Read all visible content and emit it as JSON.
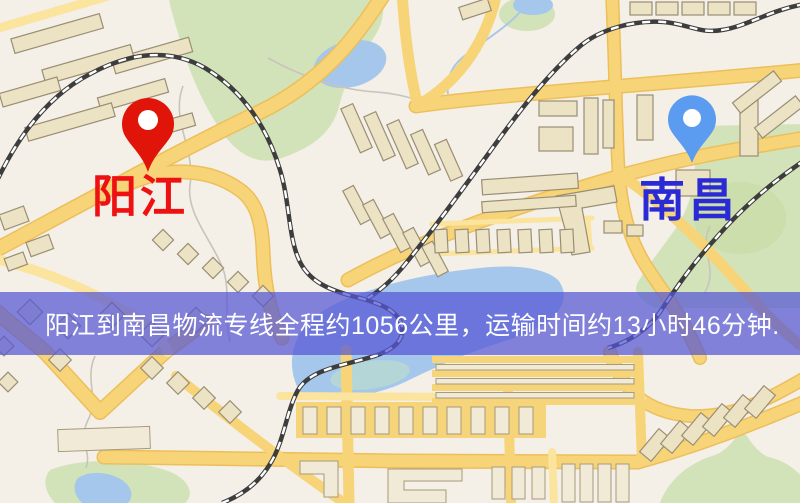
{
  "map": {
    "origin": {
      "label": "阳江",
      "pin_color": "#ee2211",
      "pin_color_dark": "#e01408",
      "label_color": "#ee1111"
    },
    "destination": {
      "label": "南昌",
      "pin_color": "#5b9bf0",
      "label_color": "#2b2bd5"
    },
    "palette": {
      "background": "#f4efe7",
      "road": "#f8d478",
      "park": "#d2e3b9",
      "water": "#a5c7ec",
      "railway": "#3d3d3d"
    }
  },
  "banner": {
    "text": "阳江到南昌物流专线全程约1056公里，运输时间约13小时46分钟.",
    "background": "rgba(84,86,213,0.72)",
    "text_color": "#ffffff"
  }
}
